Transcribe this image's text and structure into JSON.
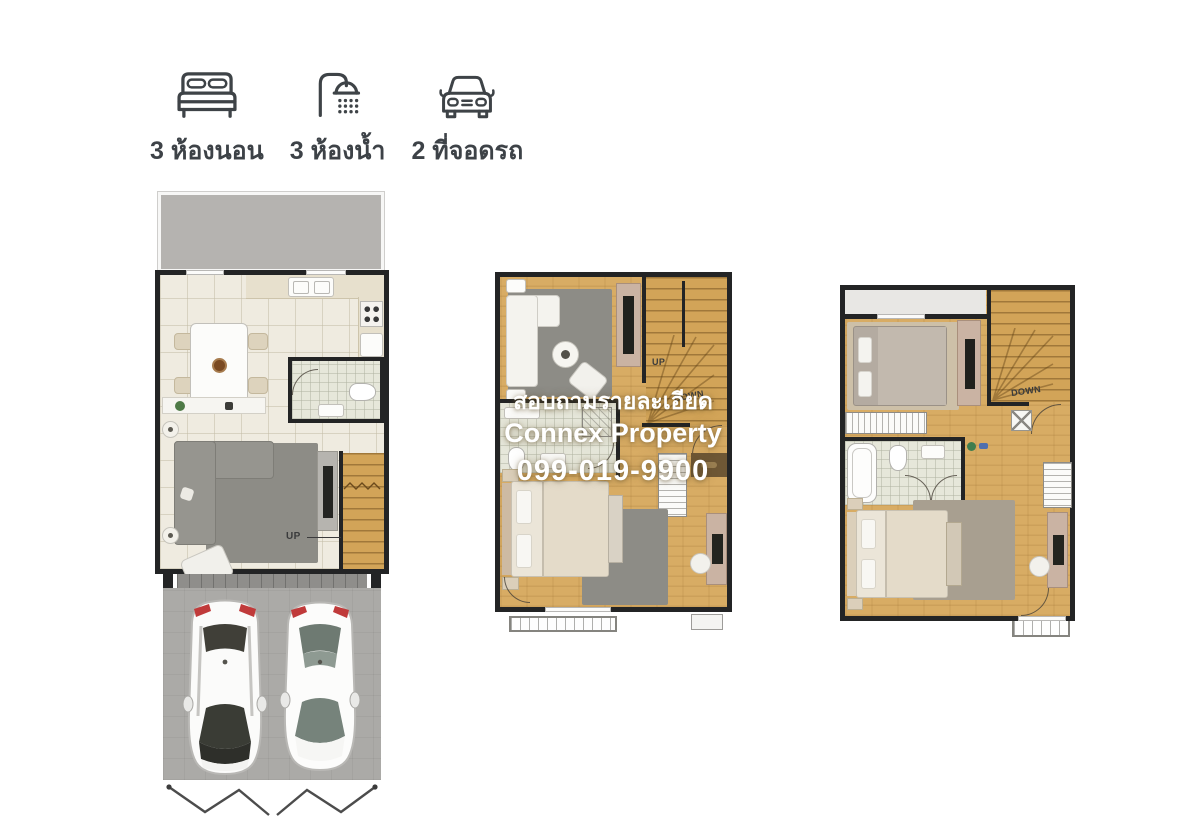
{
  "features": {
    "items": [
      {
        "icon": "bed-icon",
        "label": "3 ห้องนอน"
      },
      {
        "icon": "shower-icon",
        "label": "3 ห้องน้ำ"
      },
      {
        "icon": "car-icon",
        "label": "2 ที่จอดรถ"
      }
    ]
  },
  "watermark": {
    "line1": "สอบถามรายละเอียด",
    "line2": "Connex Property",
    "line3": "099-019-9900"
  },
  "plans": {
    "floor1": {
      "up_label": "UP"
    },
    "floor2": {
      "up_label": "UP",
      "down_label": "DOWN"
    },
    "floor3": {
      "down_label": "DOWN"
    }
  },
  "colors": {
    "wall": "#232425",
    "wood_floor": "#d8ac64",
    "tile_floor": "#efebe0",
    "bath_floor": "#e6e7da",
    "terrace_gray": "#b5b3b0",
    "driveway_gray": "#abaaa7",
    "rug_gray": "#8d8c86",
    "accent_tan": "#cab3a3",
    "icon_text": "#3d4247",
    "watermark_white": "#ffffff"
  }
}
